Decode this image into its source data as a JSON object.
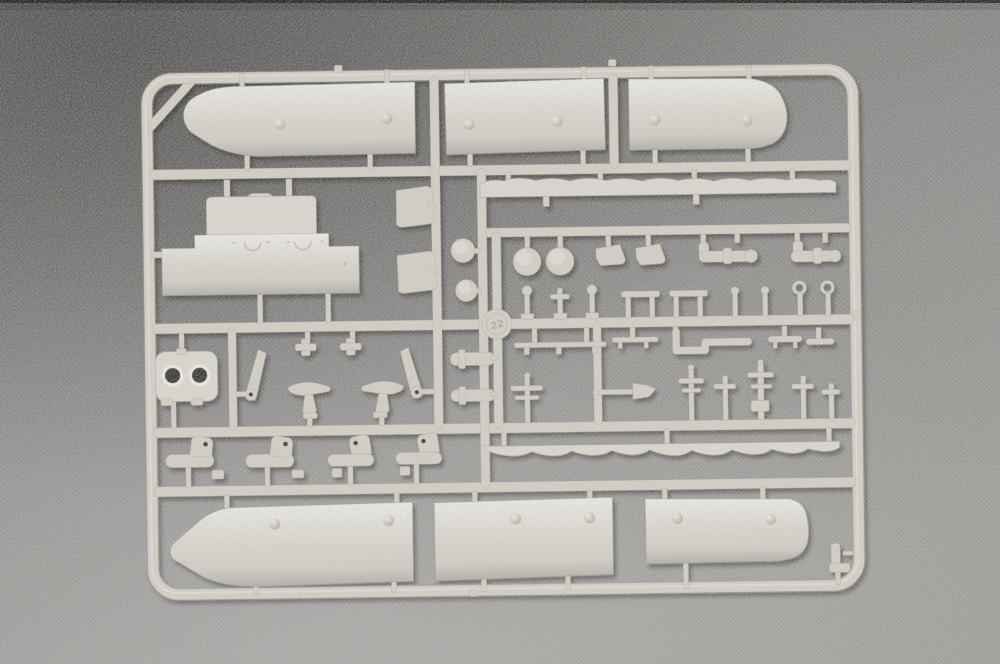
{
  "image": {
    "subject": "light grey injection-molded plastic model kit sprue (parts tree) photographed on a dark grey textured surface",
    "kit_style": "ship model parts runner"
  },
  "sprue": {
    "tag_number": "22",
    "plastic_color_name": "light grey",
    "orientation": "landscape"
  },
  "parts_inventory": {
    "hull_side_panels_top": 3,
    "hull_side_panels_bottom": 3,
    "wave_pattern_strips": 2,
    "superstructure_plate": 1,
    "twin_hole_housing": 1,
    "trapezoid_brackets": 2,
    "round_discs": 4,
    "davit_blades": 2,
    "support_tables": 2,
    "cross_fittings": 2,
    "cylinder_parts": 2,
    "stanchions": 9,
    "elbow_pipes": 2,
    "boot_shaped_fittings": 5,
    "masts_and_booms": 7
  },
  "colors": {
    "bg_top": "#6f6d6a",
    "bg_mid": "#8b8987",
    "bg_bottom": "#9e9c99",
    "top_border": "#151515",
    "plastic": "#d3d0c6",
    "plastic_panel": "#dcd9d1",
    "plastic_light": "#f0eee6",
    "plastic_dark": "#a19e93",
    "hole": "#33312d"
  }
}
